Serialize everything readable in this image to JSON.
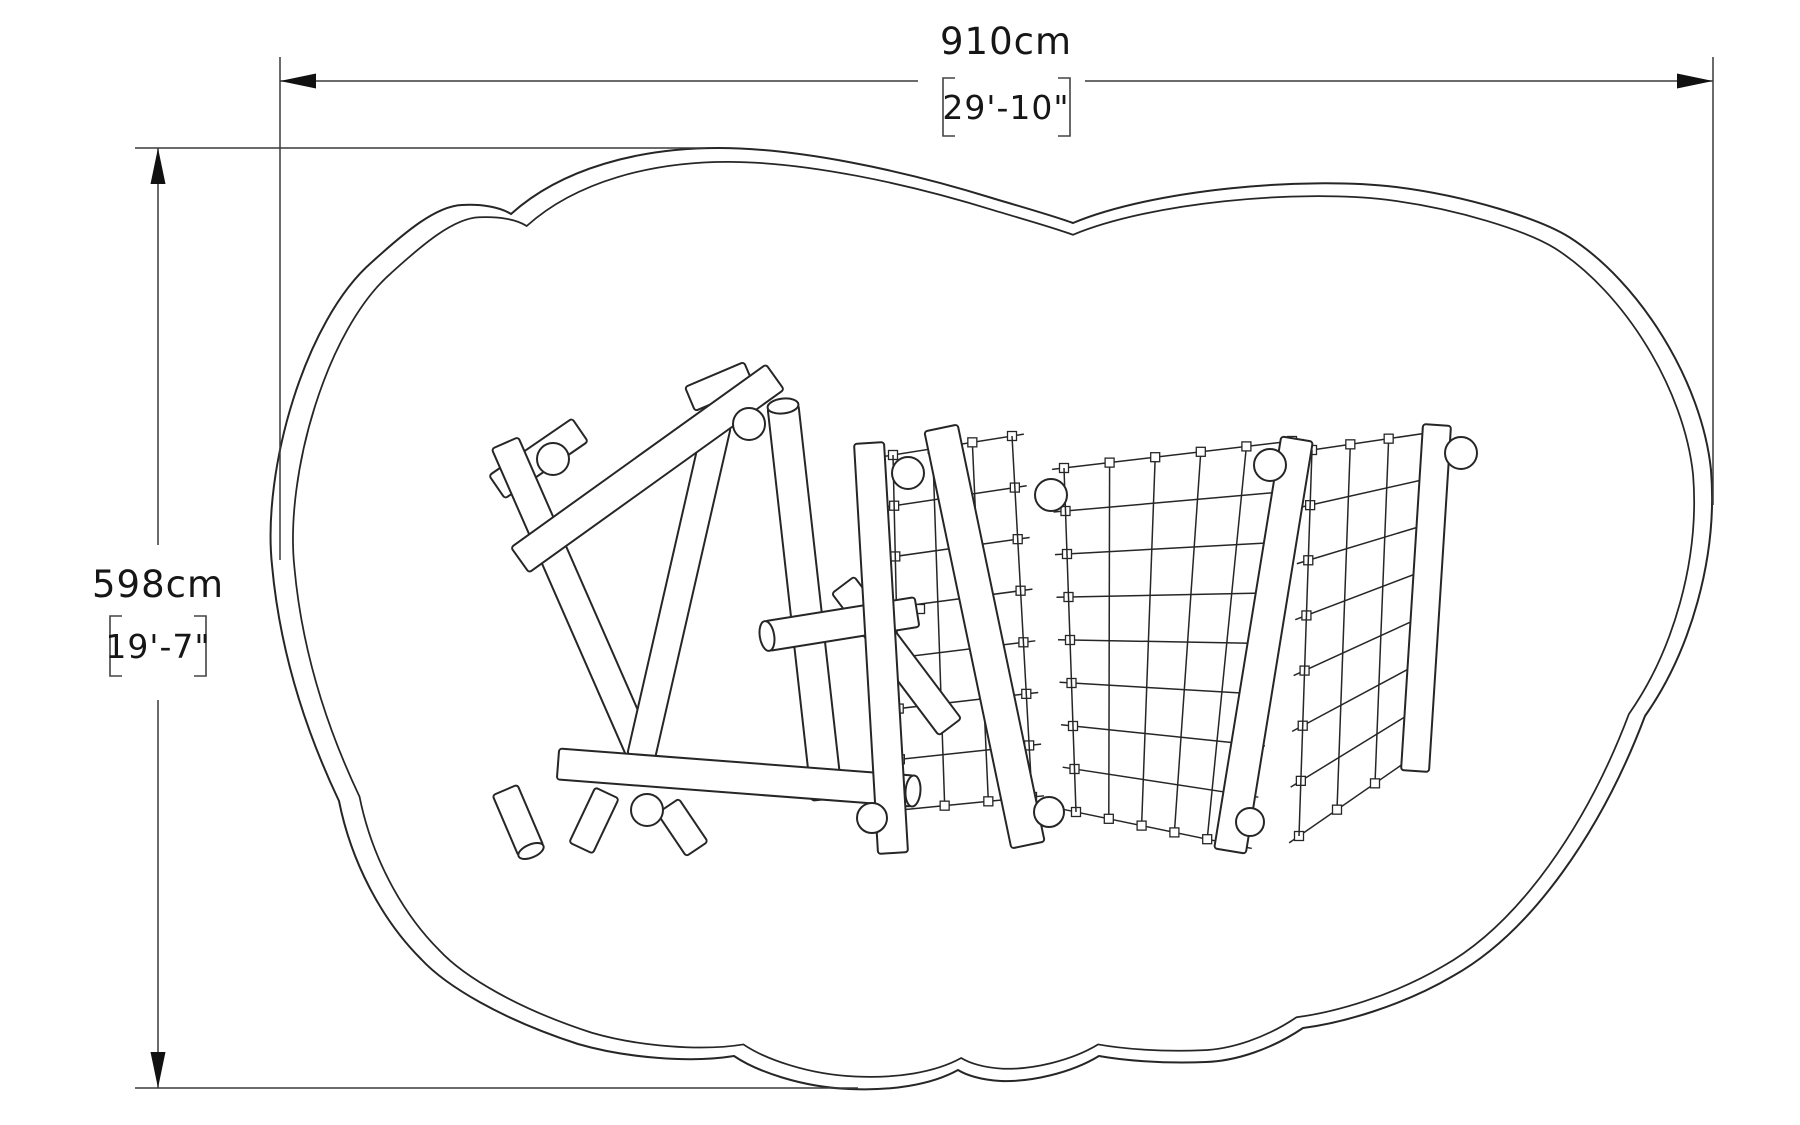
{
  "dimensions": {
    "width": {
      "primary": "910cm",
      "secondary": "29'-10\""
    },
    "height": {
      "primary": "598cm",
      "secondary": "19'-7\""
    }
  },
  "colors": {
    "line": "#262626",
    "dimension_line": "#3a3a3a",
    "background": "#ffffff"
  }
}
